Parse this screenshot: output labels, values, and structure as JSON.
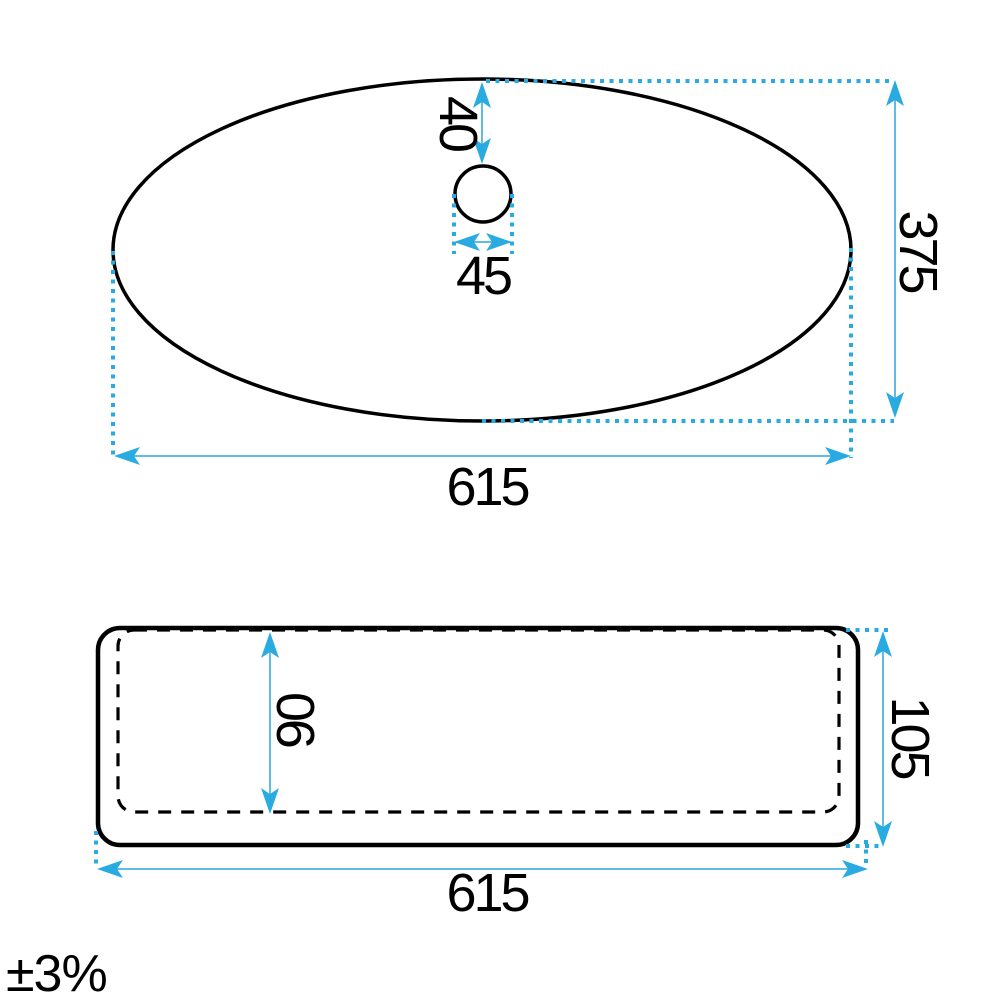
{
  "tolerance_note": "±3%",
  "colors": {
    "background": "#FFFFFF",
    "outline": "#000000",
    "accent": "#29ABE2",
    "dimension_line": "#5FBCE6"
  },
  "views": {
    "top": {
      "dimensions": {
        "hole_offset": "40",
        "hole_diameter": "45",
        "depth": "375",
        "width": "615"
      }
    },
    "side": {
      "dimensions": {
        "inner_depth": "90",
        "height": "105",
        "width": "615"
      }
    }
  }
}
